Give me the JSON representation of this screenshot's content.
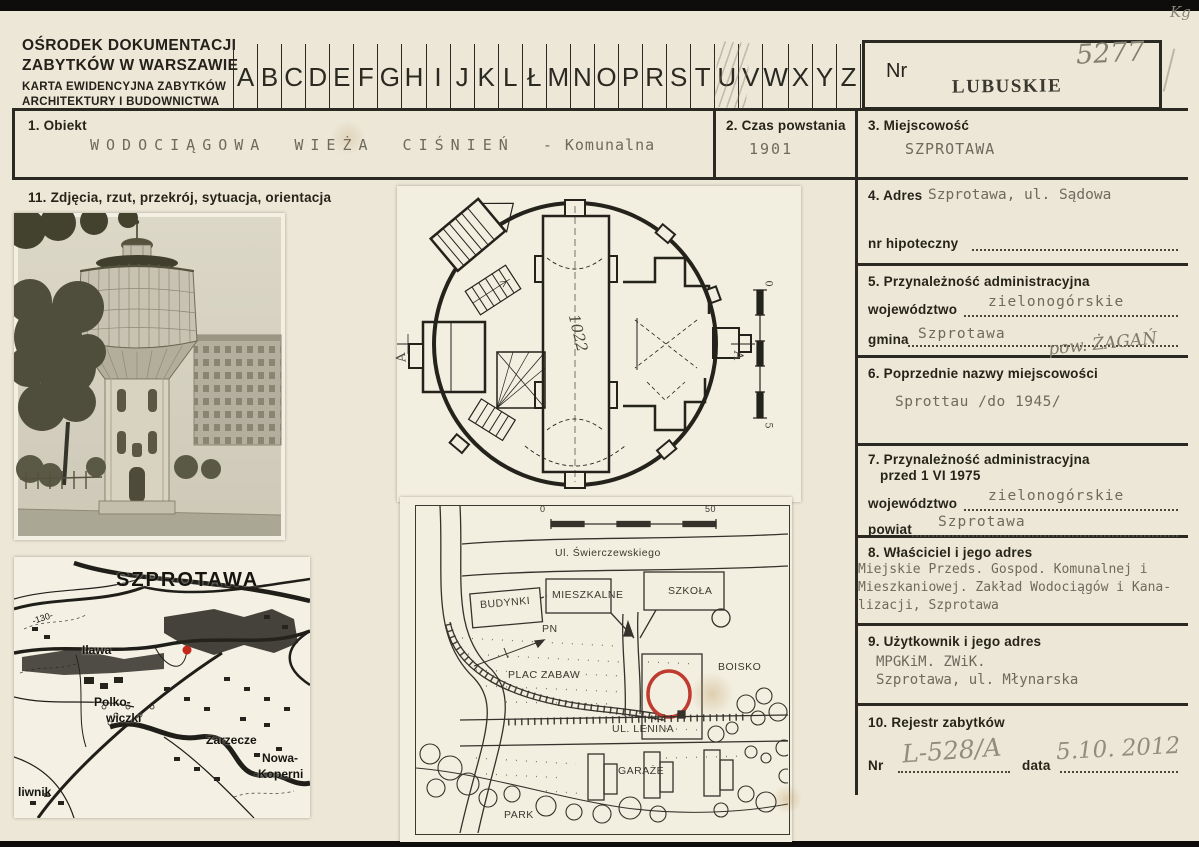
{
  "header": {
    "org": {
      "line1": "OŚRODEK DOKUMENTACJI",
      "line2": "ZABYTKÓW W WARSZAWIE",
      "line3": "KARTA EWIDENCYJNA ZABYTKÓW",
      "line4": "ARCHITEKTURY I BUDOWNICTWA"
    },
    "alphabet": [
      "A",
      "B",
      "C",
      "D",
      "E",
      "F",
      "G",
      "H",
      "I",
      "J",
      "K",
      "L",
      "Ł",
      "M",
      "N",
      "O",
      "P",
      "R",
      "S",
      "T",
      "U",
      "V",
      "W",
      "X",
      "Y",
      "Z"
    ],
    "nr_label": "Nr",
    "nr_value": "5277",
    "region_stamp": "LUBUSKIE",
    "corner_mark": "Kg"
  },
  "fields": {
    "obiekt": {
      "label": "1. Obiekt",
      "value": "WODOCIĄGOWA WIEŻA CIŚNIEŃ",
      "suffix": "- Komunalna"
    },
    "czas": {
      "label": "2. Czas powstania",
      "value": "1901"
    },
    "miejscowosc": {
      "label": "3. Miejscowość",
      "value": "SZPROTAWA"
    },
    "adres": {
      "label": "4. Adres",
      "value": "Szprotawa, ul. Sądowa",
      "hipoteczny_label": "nr hipoteczny"
    },
    "admin": {
      "label": "5. Przynależność administracyjna",
      "woj_label": "województwo",
      "woj_value": "zielonogórskie",
      "gmina_label": "gmina",
      "gmina_value": "Szprotawa",
      "handwritten": "pow. ŻAGAŃ"
    },
    "nazwy": {
      "label": "6. Poprzednie nazwy miejscowości",
      "value": "Sprottau /do 1945/"
    },
    "admin1975": {
      "label": "7. Przynależność administracyjna",
      "label2": "przed 1 VI 1975",
      "woj_label": "województwo",
      "woj_value": "zielonogórskie",
      "powiat_label": "powiat",
      "powiat_value": "Szprotawa"
    },
    "wlasciciel": {
      "label": "8. Właściciel i jego adres",
      "line1": "Miejskie Przeds. Gospod. Komunalnej i",
      "line2": "Mieszkaniowej. Zakład Wodociągów i Kana-",
      "line3": "lizacji, Szprotawa"
    },
    "uzytkownik": {
      "label": "9. Użytkownik i jego adres",
      "line1": "MPGKiM. ZWiK.",
      "line2": "Szprotawa, ul. Młynarska"
    },
    "rejestr": {
      "label": "10. Rejestr zabytków",
      "nr_label": "Nr",
      "nr_value": "L-528/A",
      "data_label": "data",
      "data_value": "5.10. 2012"
    },
    "zdjecia": {
      "label": "11. Zdjęcia, rzut, przekrój, sytuacja, orientacja"
    }
  },
  "map": {
    "city": "SZPROTAWA",
    "contour": "-130-",
    "ilawa": "Iława",
    "polko1": "Polko-",
    "polko2": "wiczki",
    "zarzecze": "Zarzecze",
    "nowa1": "Nowa-",
    "nowa2": "-Koperni",
    "liwnik": "liwnik"
  },
  "floor_plan": {
    "dimension": "1022",
    "section_left": "A",
    "section_right": "A",
    "scale_top": "0",
    "scale_bottom": "5"
  },
  "site_plan": {
    "scale_start": "0",
    "scale_end": "50",
    "street_top": "Ul. Świerczewskiego",
    "street_mid": "UL. LENINA",
    "budynki": "BUDYNKI",
    "mieszkalne": "MIESZKALNE",
    "szkola": "SZKOŁA",
    "pn": "PN",
    "plac_zabaw": "PLAC ZABAW",
    "boisko": "BOISKO",
    "garaze": "GARAŻE",
    "park": "PARK"
  },
  "colors": {
    "accent_red": "#c0392b",
    "paper": "#ece7d7",
    "ink": "#2b2a22"
  }
}
